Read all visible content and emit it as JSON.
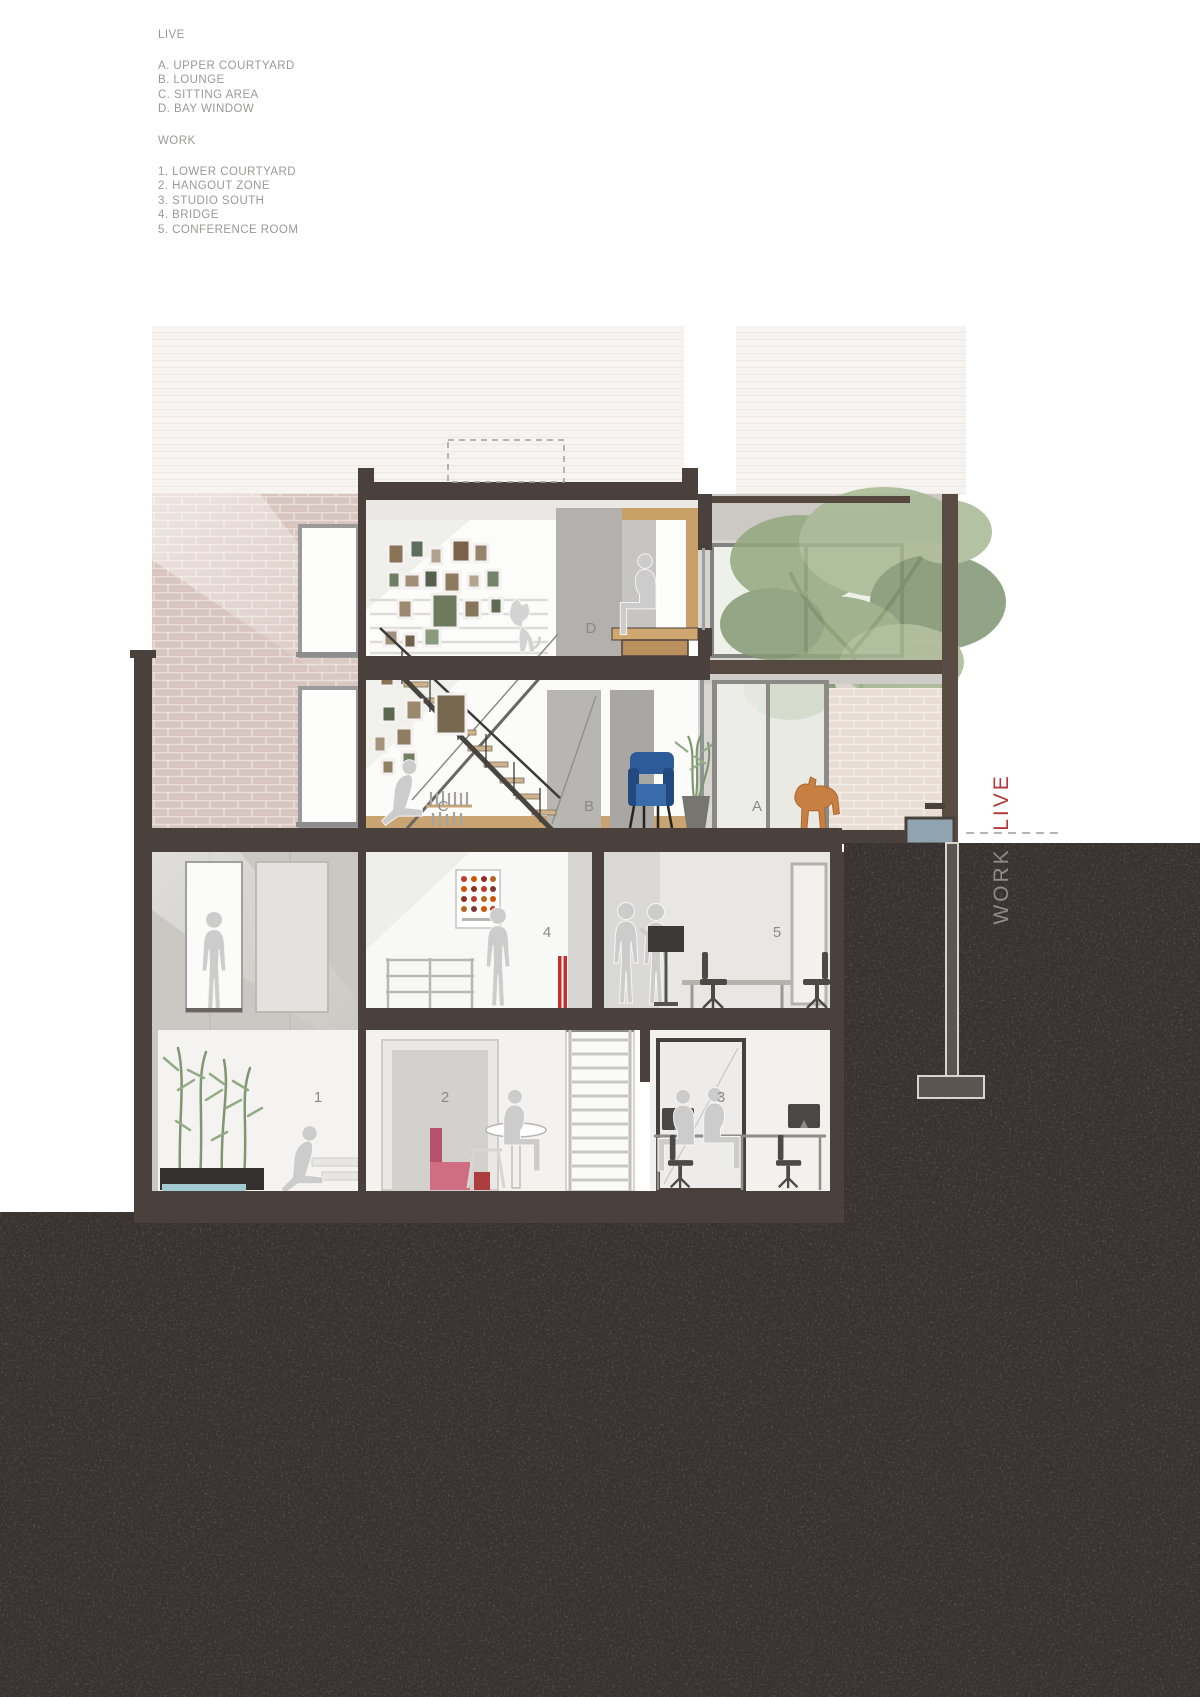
{
  "legend": {
    "live_title": "LIVE",
    "live_items": [
      "A. UPPER COURTYARD",
      "B. LOUNGE",
      "C. SITTING AREA",
      "D. BAY WINDOW"
    ],
    "work_title": "WORK",
    "work_items": [
      "1. LOWER COURTYARD",
      "2. HANGOUT ZONE",
      "3. STUDIO SOUTH",
      "4. BRIDGE",
      "5. CONFERENCE ROOM"
    ]
  },
  "section_labels": {
    "upper_courtyard": "A",
    "lounge": "B",
    "sitting_area": "C",
    "bay_window": "D",
    "lower_courtyard": "1",
    "hangout_zone": "2",
    "studio_south": "3",
    "bridge": "4",
    "conference_room": "5"
  },
  "axis": {
    "live": "LIVE",
    "work": "WORK"
  },
  "colors": {
    "live_red": "#b5373a",
    "work_gray": "#8f8b88",
    "poche_brown": "#4a413c",
    "ground_dark": "#37322f",
    "armchair_blue": "#2d5b9a",
    "horse_orange": "#c87f42",
    "accent_red": "#c4312d",
    "water_teal": "#a3ccd1",
    "brick_pink": "#d8c5bf",
    "wood": "#cba671"
  }
}
